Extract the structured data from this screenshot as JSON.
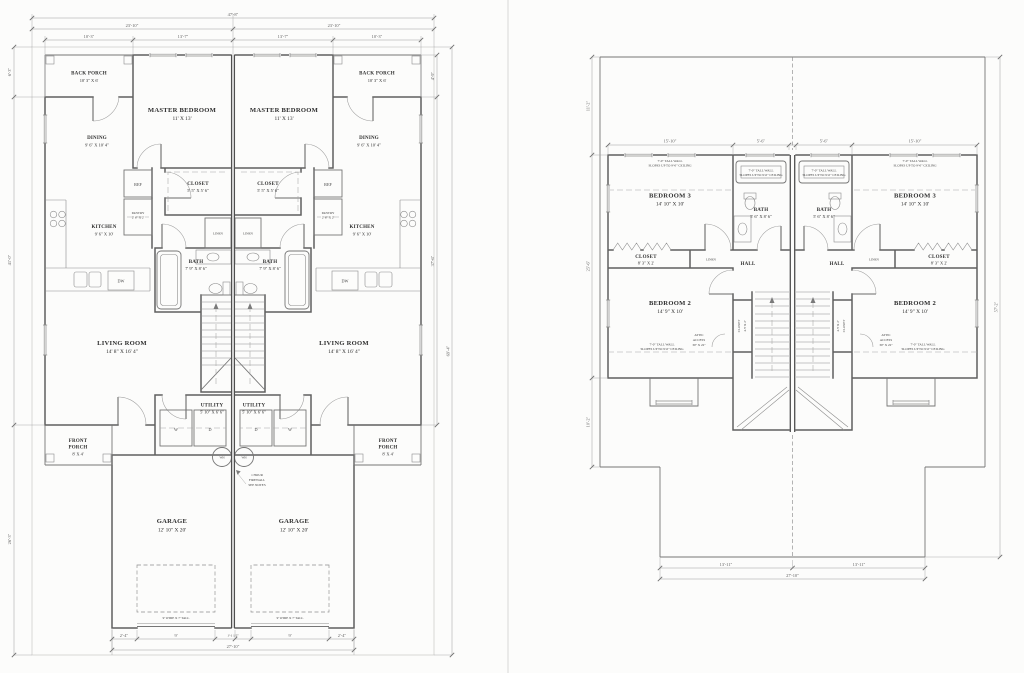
{
  "colors": {
    "wall": "#5f5f5f",
    "thin_line": "#8d8d8d",
    "dim_text": "#5f5f5f",
    "label_text": "#2e2e2e",
    "background": "#fcfcfb"
  },
  "first_floor": {
    "rooms": {
      "back_porch": {
        "name": "BACK PORCH",
        "dims": "10' 3\" X 6'"
      },
      "master_bedroom": {
        "name": "MASTER BEDROOM",
        "dims": "11' X 13'"
      },
      "dining": {
        "name": "DINING",
        "dims": "9' 6\" X 10' 4\""
      },
      "kitchen": {
        "name": "KITCHEN",
        "dims": "9' 6\" X 10'"
      },
      "closet": {
        "name": "CLOSET",
        "dims": "5' 5\" X 5' 6\""
      },
      "pantry": {
        "name": "PANTRY",
        "dims": "2' 6\" X 2'"
      },
      "bath": {
        "name": "BATH",
        "dims": "7' 9\" X 8' 6\""
      },
      "living_room": {
        "name": "LIVING ROOM",
        "dims": "14' 8\" X 16' 4\""
      },
      "utility": {
        "name": "UTILITY",
        "dims": "5' 10\" X 6' 6\""
      },
      "front_porch": {
        "line1": "FRONT",
        "line2": "PORCH",
        "dims": "8' X 4'"
      },
      "garage": {
        "name": "GARAGE",
        "dims": "12' 10\" X 20'"
      },
      "linen": "LINEN"
    },
    "fixtures": {
      "ref": "REF",
      "dishwasher": "DW",
      "washer": "W",
      "dryer": "D",
      "water_heater": "WH"
    },
    "notes": {
      "firewall": [
        "1 HOUR",
        "FIREWALL",
        "SEE NOTES"
      ],
      "garage_door": "9' WIDE X 7' TALL"
    },
    "dims": {
      "overall_w": "47'-8\"",
      "half_w": "23'-10\"",
      "porch_w": "10'-3\"",
      "master_w": "13'-7\"",
      "side": "2'-4\"",
      "door_w": "9'",
      "jamb": "1'-1 1/2\"",
      "garage_w": "27'-10\"",
      "left_a": "6'-3\"",
      "left_b": "41'-0\"",
      "left_c": "26'-3\"",
      "overall_h": "69'-4\"",
      "right_a": "4'-9\"",
      "right_b": "37'-6\""
    }
  },
  "second_floor": {
    "rooms": {
      "bedroom3": {
        "name": "BEDROOM 3",
        "dims": "14' 10\" X 10'"
      },
      "bedroom2": {
        "name": "BEDROOM 2",
        "dims": "14' 9\" X 10'"
      },
      "bath": {
        "name": "BATH",
        "dims": "5' 6\" X 8' 6\""
      },
      "closet": {
        "name": "CLOSET",
        "dims": "8' 3\" X 2'"
      },
      "closet2": {
        "name": "CLOSET",
        "dims": "4.5' X 2'"
      },
      "hall": "HALL",
      "linen": "LINEN"
    },
    "notes": {
      "slope": [
        "7'-0\" TALL WALL",
        "SLOPES UP TO 9'-0\" CEILING"
      ],
      "attic": [
        "ATTIC",
        "ACCESS",
        "30\" X 22\""
      ]
    },
    "dims": {
      "bedroom_w": "15'-10\"",
      "bath_w": "5'-6\"",
      "left_a": "11'-2\"",
      "left_b": "25'-6\"",
      "left_c": "10'-2\"",
      "overall_h": "57'-2\"",
      "bottom_half": "13'-11\"",
      "bottom_w": "27'-10\""
    }
  }
}
